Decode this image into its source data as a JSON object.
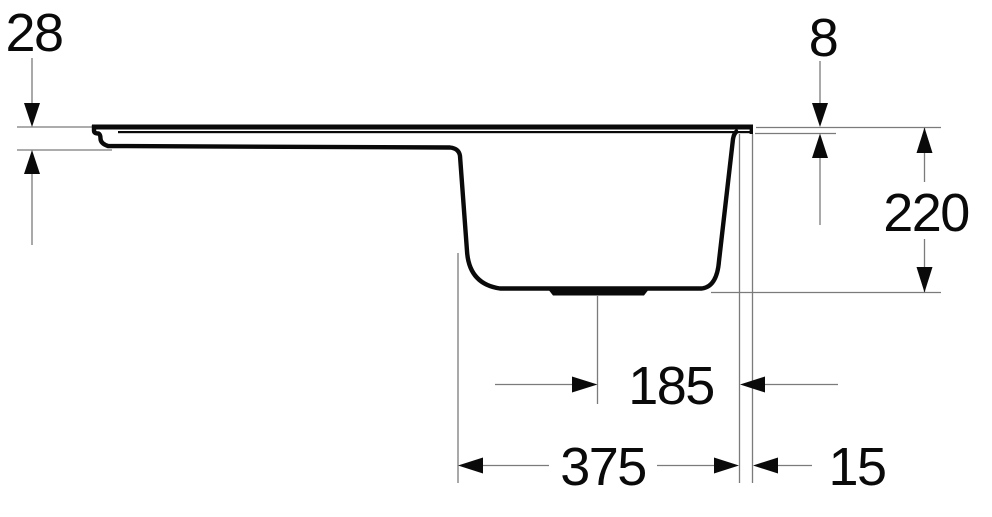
{
  "drawing": {
    "description": "Technical side-view cross-section drawing of a kitchen sink with drainboard and bowl, annotated with dimension lines",
    "dims": {
      "top_left_thickness": "28",
      "top_right_edge_thickness": "8",
      "bowl_depth": "220",
      "drain_to_right_edge": "185",
      "bowl_width": "375",
      "bowl_to_outer_edge": "15"
    },
    "colors": {
      "ink": "#0a0a0a",
      "thin_line": "#7b7b7b",
      "background": "#ffffff"
    }
  }
}
